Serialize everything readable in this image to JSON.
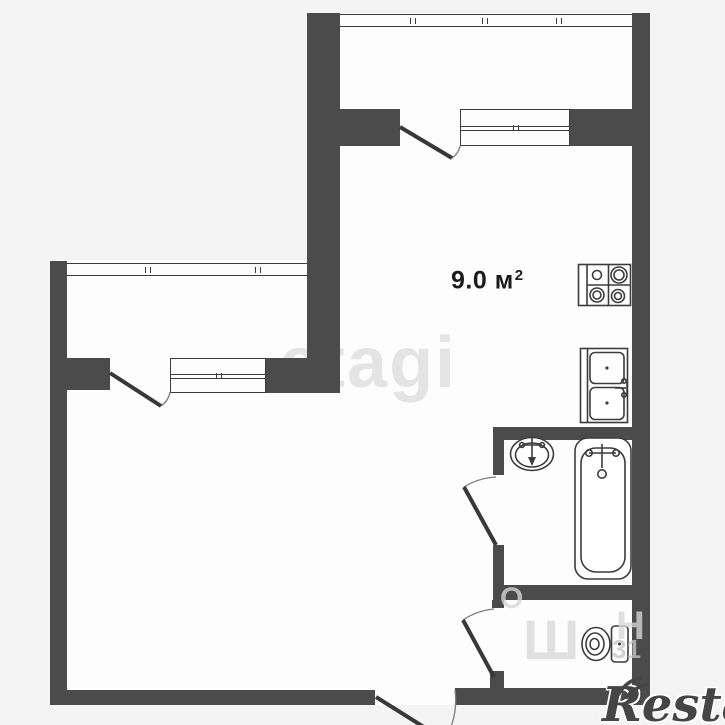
{
  "plan": {
    "kitchen": {
      "area_text": "9.0 м",
      "area_sup": "2"
    }
  },
  "watermarks": {
    "center": "etagi",
    "brand": "Restate",
    "frag_o": "О",
    "frag_sh": "Ш",
    "frag_n": "Н",
    "frag_31": "31"
  },
  "colors": {
    "wall": "#4b4b4b",
    "line": "#3c3c3c",
    "leaf": "#383838",
    "arc": "#7d7d7d",
    "bg": "#f4f4f5",
    "room": "#fdfdfd",
    "wm_center": "#e4e4e4",
    "wm_fragment": "#d8d8d8",
    "brand": "#454545",
    "label": "#1b1b1b"
  }
}
